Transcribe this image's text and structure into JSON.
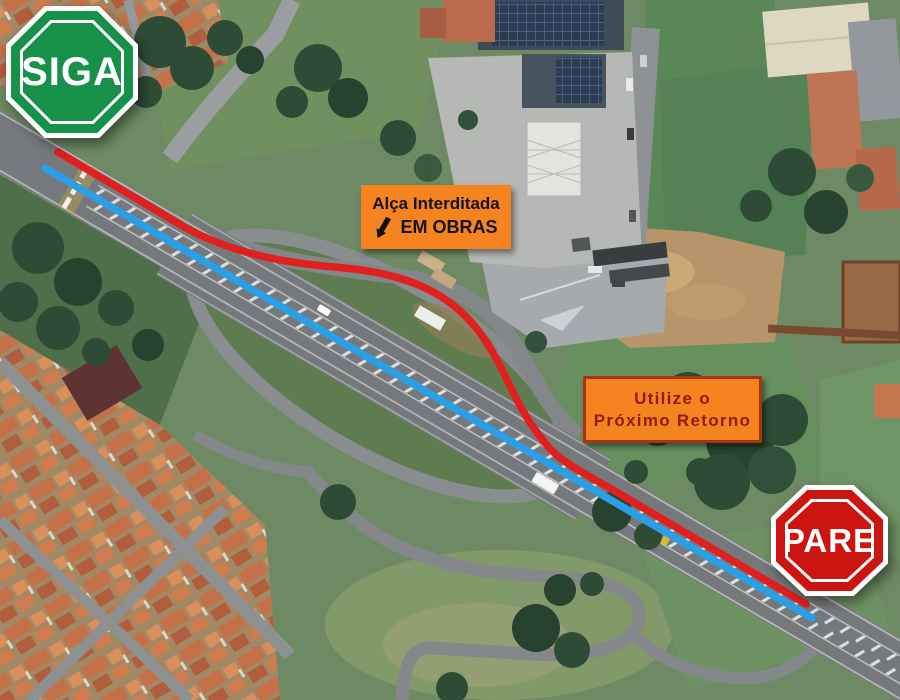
{
  "signs": {
    "siga": {
      "label": "SIGA",
      "fill_color": "#17914a"
    },
    "pare": {
      "label": "PARE",
      "fill_color": "#cc1510"
    },
    "closure_banner": {
      "line1": "Alça Interditada",
      "line2": "EM OBRAS",
      "icon": "arrow-down-left-icon",
      "bg_color": "#f5831f",
      "text_color": "#151310"
    },
    "detour_banner": {
      "line1": "Utilize o",
      "line2": "Próximo Retorno",
      "bg_color": "#f5831f",
      "text_color": "#8c1d06",
      "border_color": "#a43711"
    }
  },
  "routes": {
    "closed_route_color": "#e01f1f",
    "open_route_color": "#2b9fe6"
  }
}
